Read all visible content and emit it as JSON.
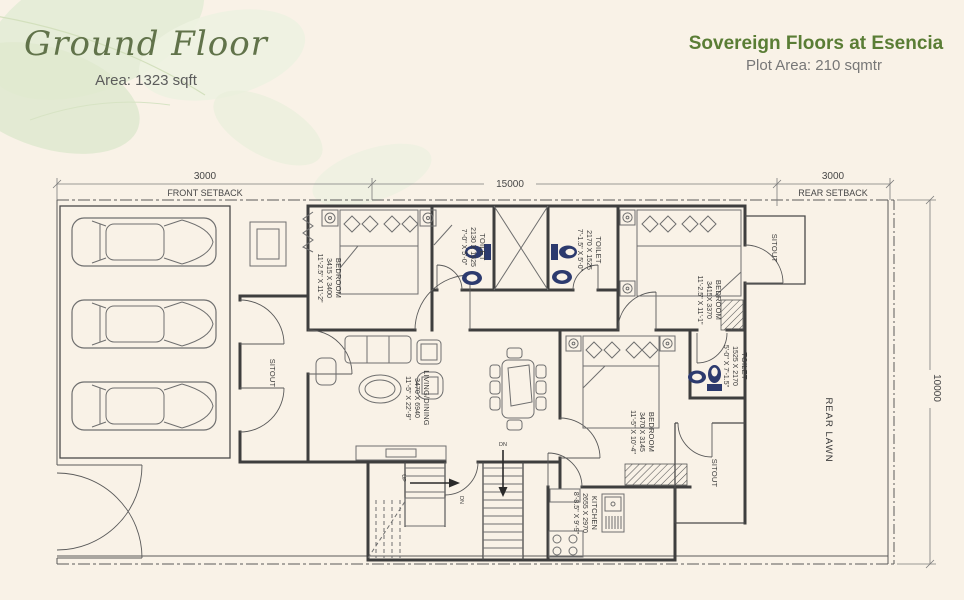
{
  "header": {
    "floor_title": "Ground Floor",
    "floor_area": "Area: 1323 sqft",
    "project_title": "Sovereign Floors at Esencia",
    "plot_area": "Plot Area: 210 sqmtr"
  },
  "dimensions": {
    "front_setback_value": "3000",
    "front_setback_label": "FRONT SETBACK",
    "width_value": "15000",
    "rear_setback_value": "3000",
    "rear_setback_label": "REAR SETBACK",
    "depth_value": "10000"
  },
  "rooms": {
    "bedroom1": {
      "name": "BEDROOM",
      "size_mm": "3415 X 3400",
      "size_ft": "11'-2.5\" X 11'-2\""
    },
    "toilet1": {
      "name": "TOILET",
      "size_mm": "2130 X 1525",
      "size_ft": "7'-0\" X 5'-0\""
    },
    "toilet2": {
      "name": "TOILET",
      "size_mm": "2170 X 1525",
      "size_ft": "7'-1.5\" X 5'-0\""
    },
    "bedroom2": {
      "name": "BEDROOM",
      "size_mm": "3415X 3370",
      "size_ft": "11'-2.5\" X 11'-1\""
    },
    "toilet3": {
      "name": "TOILET",
      "size_mm": "1525 X 2170",
      "size_ft": "5'-0\" X 7'-1.5\""
    },
    "living": {
      "name": "LIVING/DINING",
      "size_mm": "3470 X 6940",
      "size_ft": "11'-5\" X 22'-9\""
    },
    "bedroom3": {
      "name": "BEDROOM",
      "size_mm": "3470 X 3145",
      "size_ft": "11'-5\" X 10'-4\""
    },
    "kitchen": {
      "name": "KITCHEN",
      "size_mm": "2655 X 2970",
      "size_ft": "8'-8.5\" X 9'-9\""
    },
    "sitout_left": "SITOUT",
    "sitout_top_right": "SITOUT",
    "sitout_bottom_right": "SITOUT",
    "rear_lawn": "REAR LAWN"
  },
  "labels": {
    "up": "UP",
    "dn": "DN"
  },
  "colors": {
    "title_green": "#61734a",
    "brand_green": "#5a7d35",
    "paper": "#f9f2e7",
    "wall": "#3e3e3e",
    "fixture_blue": "#2c3a6e",
    "leaf_green": "#e4ecd6"
  }
}
